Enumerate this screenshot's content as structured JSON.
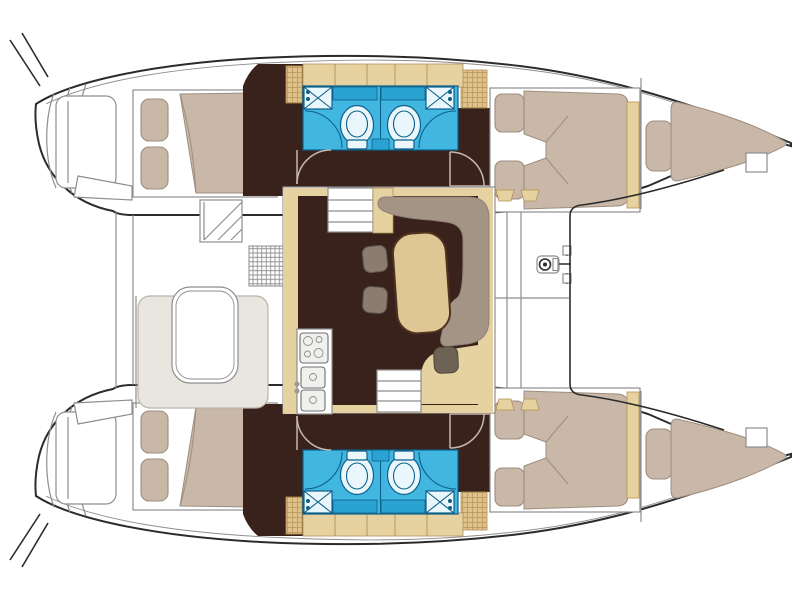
{
  "diagram": {
    "title": "Catamaran yacht floor plan, top view, bows to the right",
    "type": "boat-floor-plan",
    "orientation": {
      "bow": "right",
      "stern": "left",
      "top_hull": "port",
      "bottom_hull": "starboard"
    },
    "summary": {
      "double_cabins": 4,
      "bathrooms": 4,
      "bow_berths": 2,
      "salon_tables": 1,
      "cockpit_tables": 1
    },
    "areas": [
      {
        "id": "cockpit",
        "label": "Aft cockpit with bench seating and table"
      },
      {
        "id": "salon",
        "label": "Salon with dinette table, curved sofa and stools"
      },
      {
        "id": "galley",
        "label": "Galley with stove and twin sinks"
      },
      {
        "id": "port-aft-cabin",
        "label": "Port aft double cabin"
      },
      {
        "id": "port-bathrooms",
        "label": "Port twin bathrooms with toilets, sinks and showers"
      },
      {
        "id": "port-forward-cabin",
        "label": "Port forward double cabin"
      },
      {
        "id": "port-bow-berth",
        "label": "Port forepeak berth"
      },
      {
        "id": "foredeck",
        "label": "Foredeck walkway with anchor windlass"
      },
      {
        "id": "trampoline",
        "label": "Bow trampoline area between hulls"
      },
      {
        "id": "starboard-hull",
        "label": "Starboard hull (mirror of port): aft cabin, twin bathrooms, forward cabin, forepeak berth"
      }
    ],
    "palette": {
      "hull_line": "#2b2b2b",
      "deck_line": "#8e8e8e",
      "door_line": "#c4b8a8",
      "floor": "#3a221c",
      "wood": "#e6d1a1",
      "wood_dark": "#dfc28c",
      "wood_edge": "#b39254",
      "mattress": "#c9b7a8",
      "mattress_line": "#9d8e7f",
      "sofa": "#a39486",
      "stool": "#8a7c6e",
      "stool_dark": "#6e6254",
      "bench": "#e9e6df",
      "table": "#dfc795",
      "table_edge": "#50331f",
      "head": "#41b6e0",
      "head_dark": "#2aa3d3",
      "head_line": "#0d6089",
      "head_fixture": "#e9f7fc",
      "appliance": "#f0f0ee"
    }
  }
}
